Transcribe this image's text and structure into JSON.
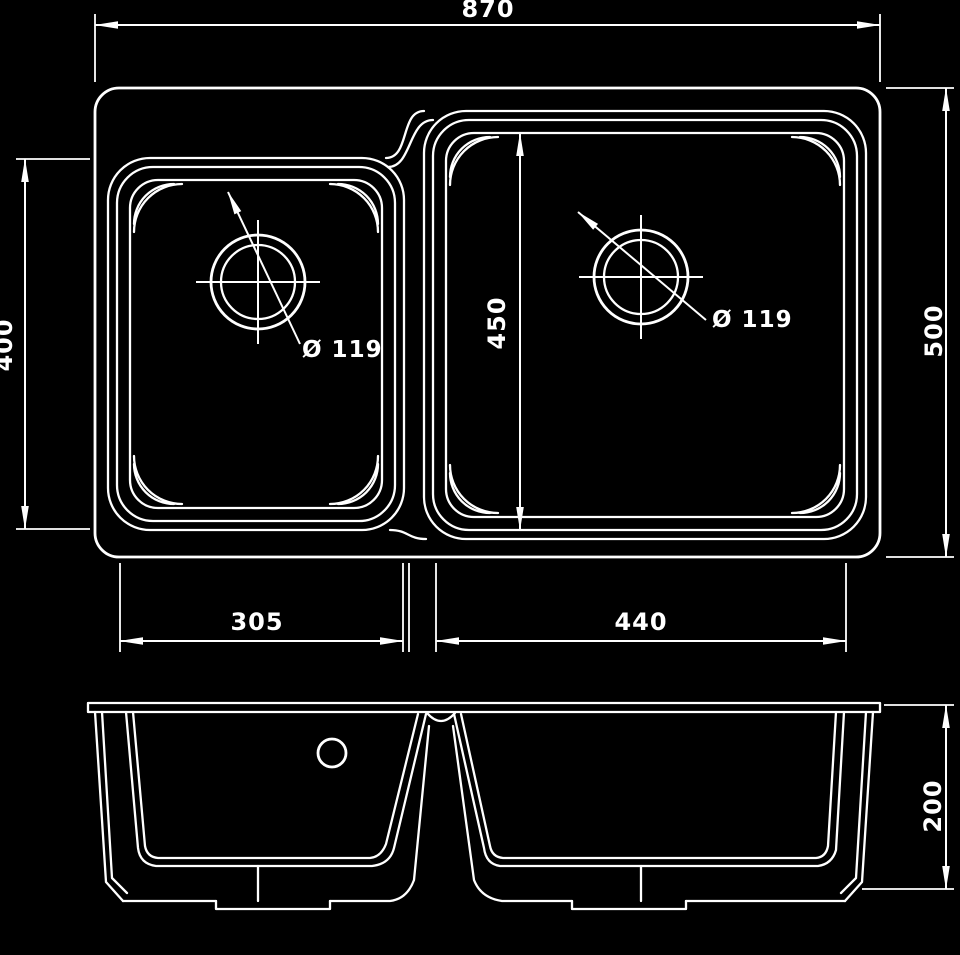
{
  "colors": {
    "background": "#000000",
    "line": "#ffffff"
  },
  "top_view": {
    "dim_overall_width": "870",
    "dim_overall_depth": "500",
    "dim_left_bowl_length": "400",
    "dim_right_bowl_length": "450",
    "dim_left_bowl_width": "305",
    "dim_right_bowl_width": "440",
    "label_left_drain": "Ø 119",
    "label_right_drain": "Ø 119"
  },
  "front_view": {
    "dim_height": "200"
  }
}
